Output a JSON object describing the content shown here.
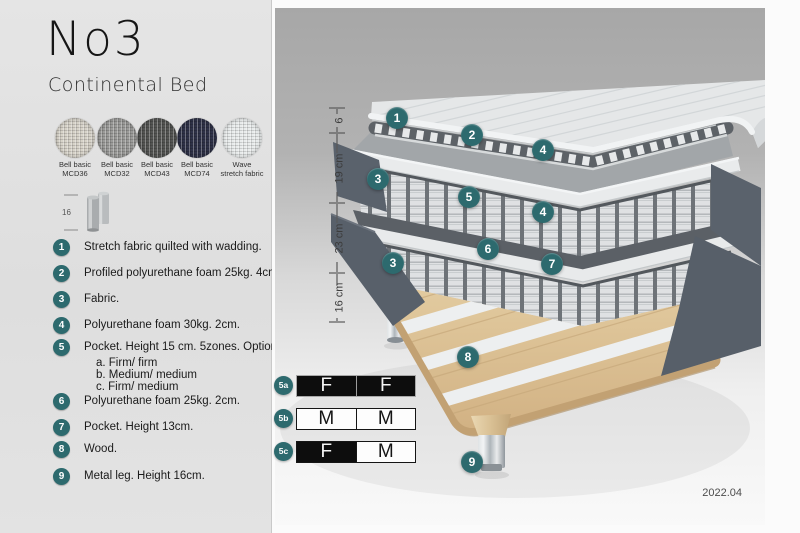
{
  "header": {
    "title": "No3",
    "subtitle": "Continental Bed"
  },
  "colors": {
    "accent": "#2d6a6e",
    "fabric_dark": "#5a626c",
    "wood": "#d7ba8e"
  },
  "swatches": [
    {
      "line1": "Bell basic",
      "line2": "MCD36",
      "color": "#d7d3c9"
    },
    {
      "line1": "Bell basic",
      "line2": "MCD32",
      "color": "#9b9b99"
    },
    {
      "line1": "Bell basic",
      "line2": "MCD43",
      "color": "#545553"
    },
    {
      "line1": "Bell basic",
      "line2": "MCD74",
      "color": "#2f3248"
    },
    {
      "line1": "Wave",
      "line2": "stretch fabric",
      "color": "#e9ecec"
    }
  ],
  "leg_detail": {
    "dimension": "16"
  },
  "materials": [
    {
      "num": "1",
      "text": "Stretch fabric quilted with wadding."
    },
    {
      "num": "2",
      "text": "Profiled polyurethane foam 25kg. 4cm."
    },
    {
      "num": "3",
      "text": "Fabric."
    },
    {
      "num": "4",
      "text": "Polyurethane foam 30kg. 2cm."
    },
    {
      "num": "5",
      "text": "Pocket. Height 15 cm. 5zones. Option:",
      "options": [
        "a. Firm/ firm",
        "b. Medium/ medium",
        "c. Firm/ medium"
      ]
    },
    {
      "num": "6",
      "text": "Polyurethane foam 25kg. 2cm."
    },
    {
      "num": "7",
      "text": "Pocket. Height 13cm."
    },
    {
      "num": "8",
      "text": "Wood."
    },
    {
      "num": "9",
      "text": "Metal leg. Height 16cm."
    }
  ],
  "diagram": {
    "dimensions": [
      "6",
      "19 cm",
      "23 cm",
      "16 cm"
    ],
    "callouts": [
      "1",
      "2",
      "3",
      "4",
      "5",
      "4",
      "6",
      "7",
      "3",
      "8",
      "9"
    ],
    "firmness": [
      {
        "id": "5a",
        "cells": [
          {
            "label": "F",
            "dark": true
          },
          {
            "label": "F",
            "dark": true
          }
        ]
      },
      {
        "id": "5b",
        "cells": [
          {
            "label": "M",
            "dark": false
          },
          {
            "label": "M",
            "dark": false
          }
        ]
      },
      {
        "id": "5c",
        "cells": [
          {
            "label": "F",
            "dark": true
          },
          {
            "label": "M",
            "dark": false
          }
        ]
      }
    ],
    "version": "2022.04"
  }
}
